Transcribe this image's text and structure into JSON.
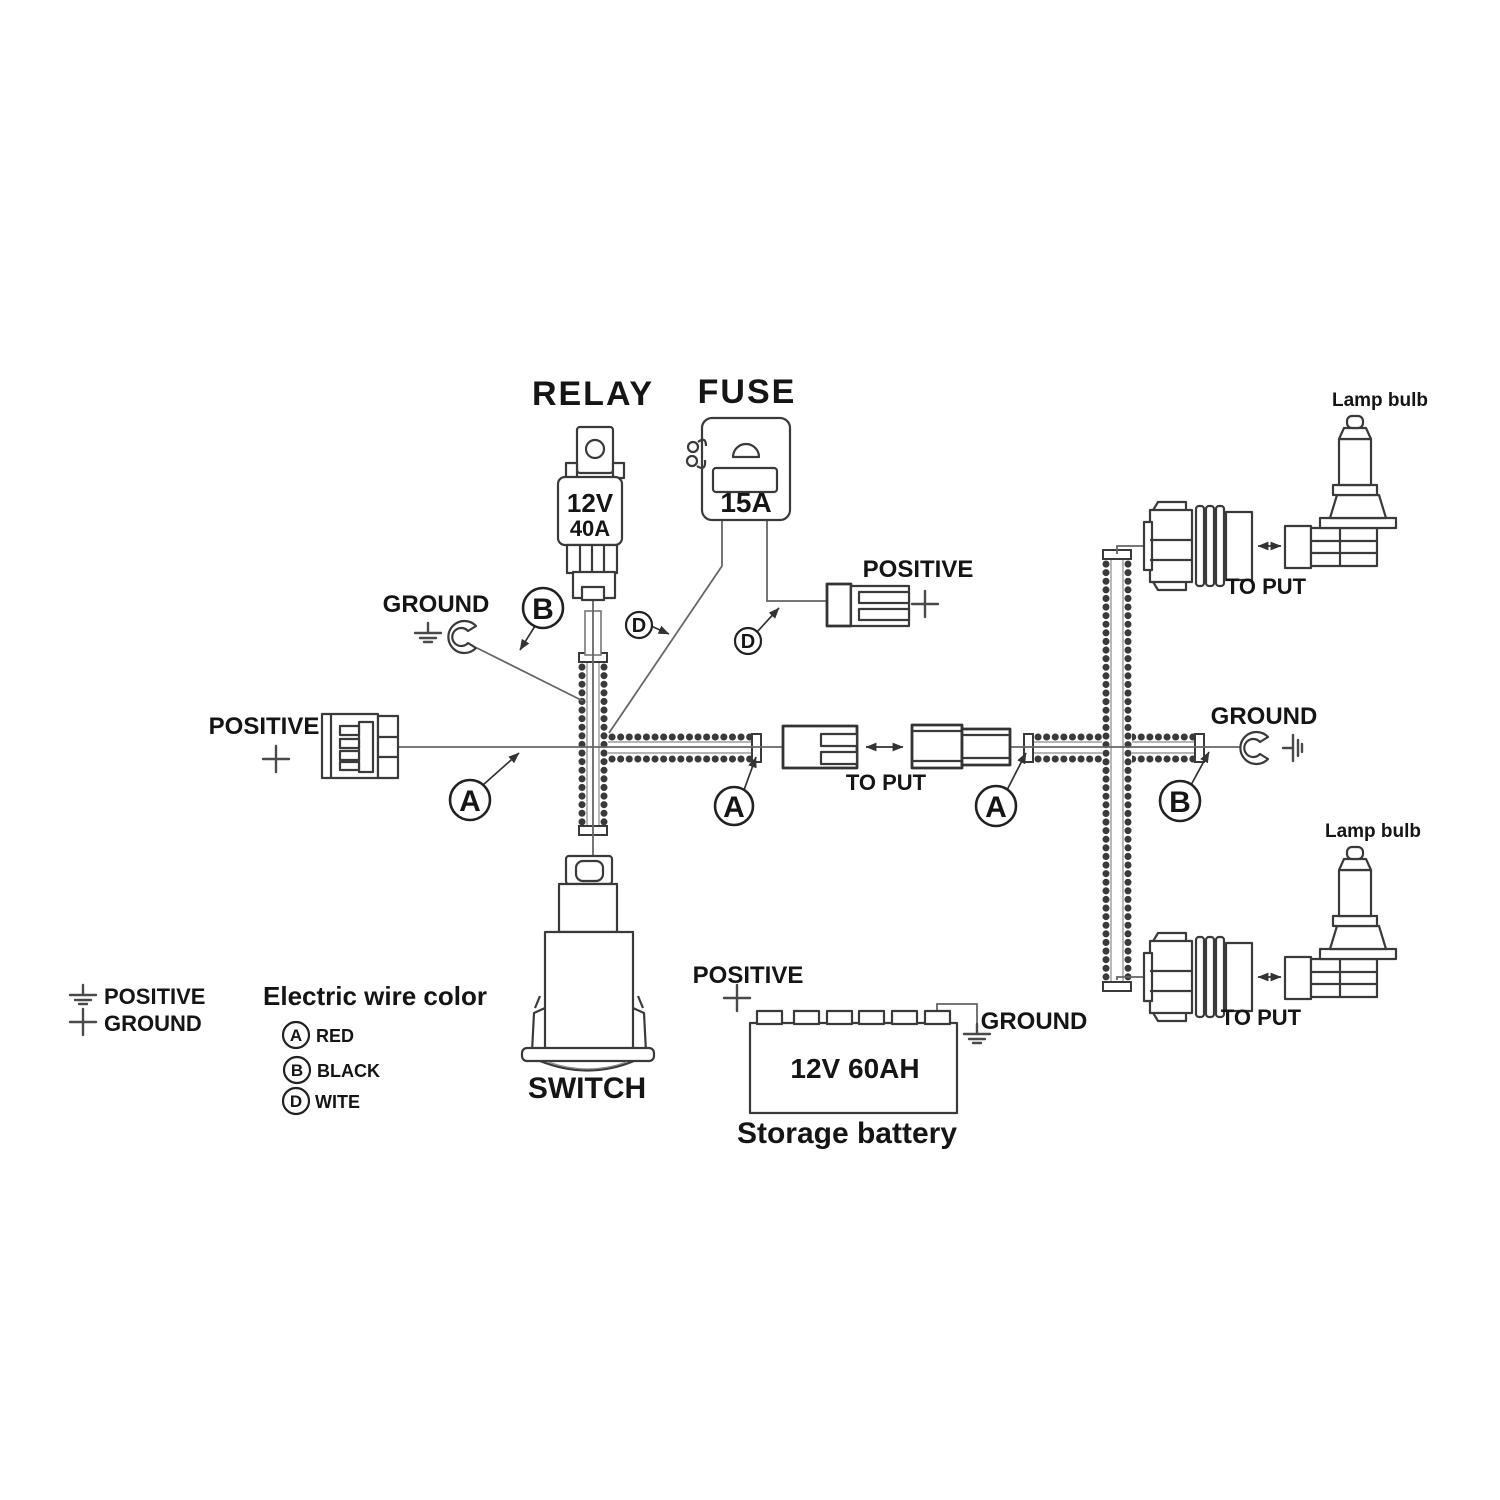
{
  "relay": {
    "title": "RELAY",
    "voltage": "12V",
    "current": "40A"
  },
  "fuse": {
    "title": "FUSE",
    "current": "15A"
  },
  "connectors": {
    "positive_top": "POSITIVE",
    "positive_left": "POSITIVE",
    "ground_upper_left": "GROUND",
    "ground_right": "GROUND",
    "to_put_middle": "TO PUT",
    "to_put_lamp_top": "TO PUT",
    "to_put_lamp_bottom": "TO PUT"
  },
  "lamps": {
    "top": "Lamp bulb",
    "bottom": "Lamp bulb"
  },
  "switch": {
    "label": "SWITCH"
  },
  "battery": {
    "positive": "POSITIVE",
    "ground": "GROUND",
    "rating": "12V 60AH",
    "caption": "Storage battery"
  },
  "markers": {
    "a": "A",
    "b": "B",
    "d": "D"
  },
  "legend": {
    "positive": "POSITIVE",
    "ground": "GROUND",
    "title": "Electric wire color",
    "colors": [
      {
        "code": "A",
        "name": "RED"
      },
      {
        "code": "B",
        "name": "BLACK"
      },
      {
        "code": "D",
        "name": "WITE"
      }
    ]
  }
}
